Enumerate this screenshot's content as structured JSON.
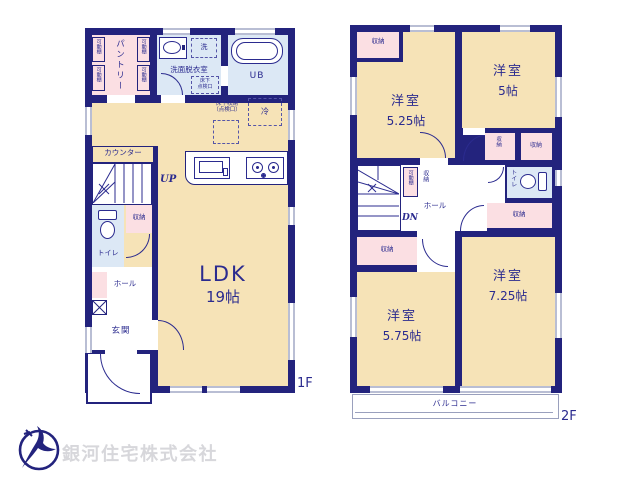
{
  "colors": {
    "wall_navy": "#23237d",
    "room_cream": "#f6e3b7",
    "closet_pink": "#fbdfe3",
    "wet_area_blue": "#dce8f5",
    "window_gray": "#b9bed4",
    "text_navy": "#2b2b8f",
    "company_text_gray": "#d7d7db"
  },
  "labels": {
    "movable_shelf": "可動棚",
    "pantry": "パントリー",
    "laundry": "洗",
    "washroom": "洗面脱衣室",
    "underfloor_hatch_line1": "床下",
    "underfloor_hatch_line2": "点検口",
    "unit_bath": "UB",
    "underfloor_storage_line1": "床下収納",
    "underfloor_storage_line2": "（点検口）",
    "refrigerator": "冷",
    "counter": "カウンター",
    "stairs_up": "UP",
    "stairs_down": "DN",
    "ldk": "LDK",
    "ldk_size": "19帖",
    "storage": "収納",
    "toilet": "トイレ",
    "hall": "ホール",
    "entrance": "玄関",
    "western_room": "洋室",
    "balcony": "バルコニー",
    "floor1_tag": "1F",
    "floor2_tag": "2F"
  },
  "floor2_room_sizes": {
    "top_left": "5.25帖",
    "top_right": "5帖",
    "bottom_left": "5.75帖",
    "bottom_right": "7.25帖"
  },
  "footer": {
    "company_name": "銀河住宅株式会社"
  }
}
